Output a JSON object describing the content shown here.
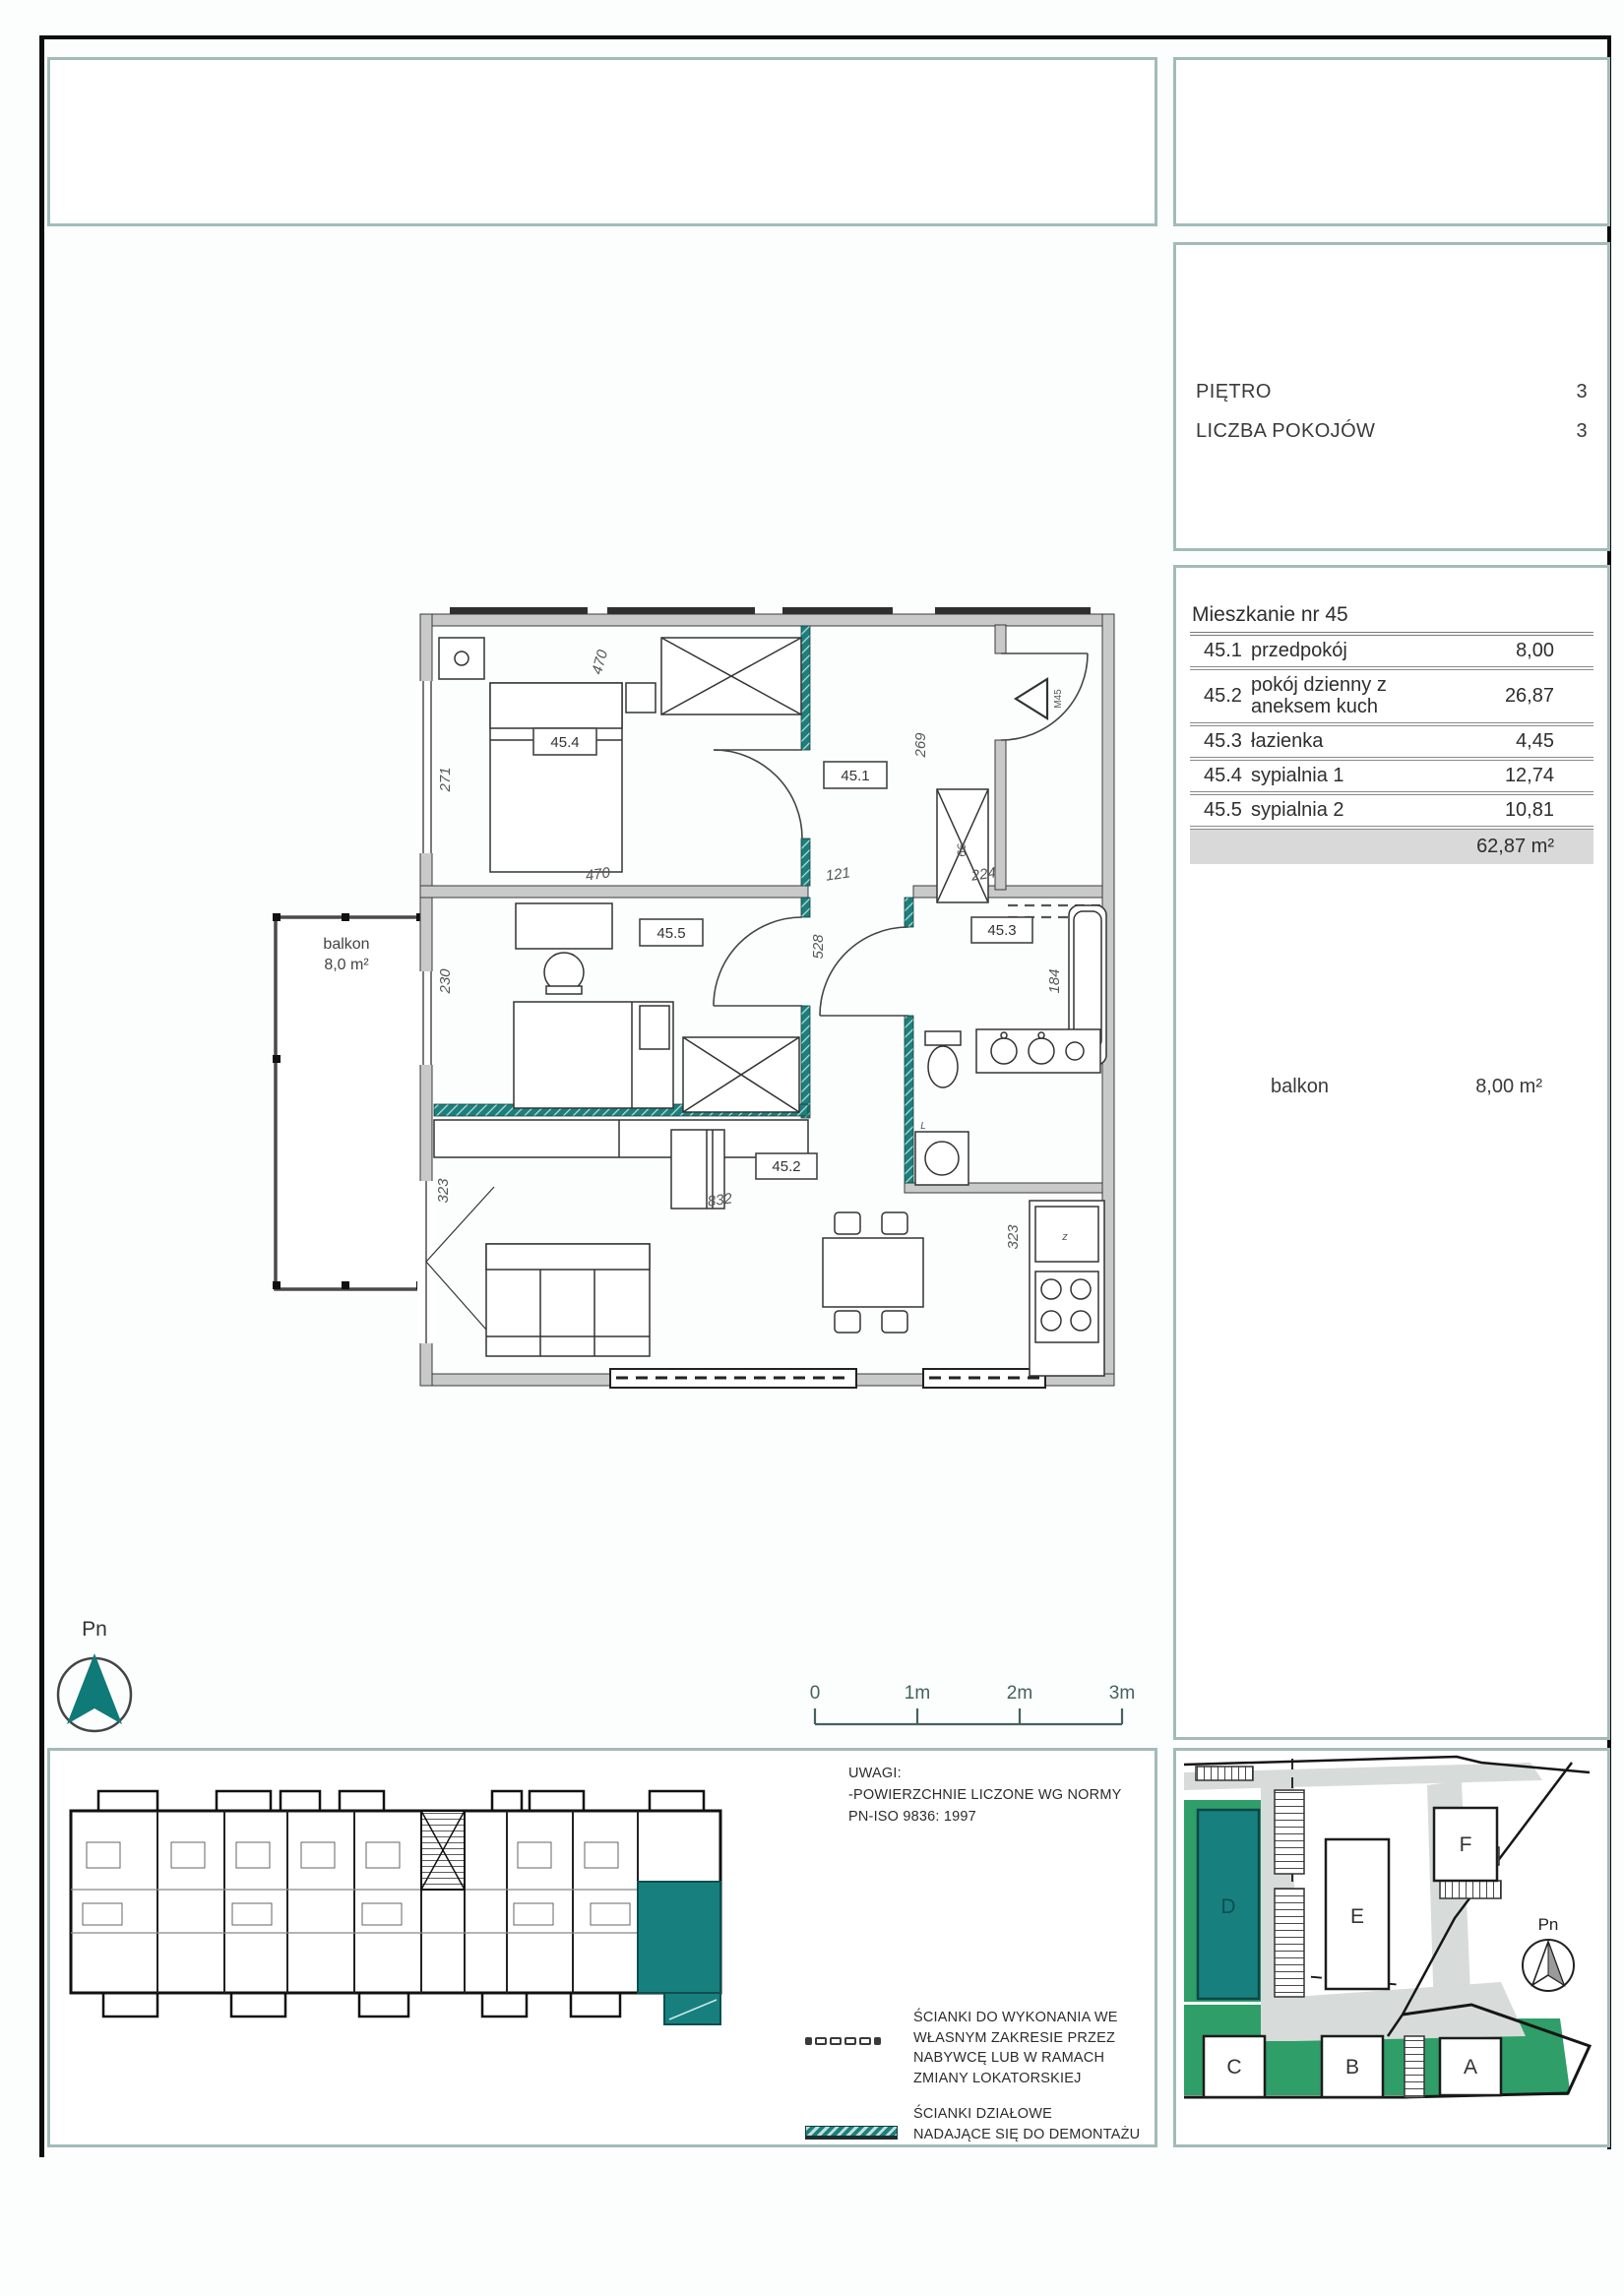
{
  "info_panel": {
    "floor_label": "PIĘTRO",
    "floor_value": "3",
    "rooms_label": "LICZBA POKOJÓW",
    "rooms_value": "3"
  },
  "apartment": {
    "title": "Mieszkanie nr 45",
    "rows": [
      {
        "no": "45.1",
        "name": "przedpokój",
        "area": "8,00"
      },
      {
        "no": "45.2",
        "name": "pokój dzienny z\naneksem kuch",
        "area": "26,87"
      },
      {
        "no": "45.3",
        "name": "łazienka",
        "area": "4,45"
      },
      {
        "no": "45.4",
        "name": "sypialnia 1",
        "area": "12,74"
      },
      {
        "no": "45.5",
        "name": "sypialnia 2",
        "area": "10,81"
      }
    ],
    "total_area": "62,87 m²",
    "balcony_label": "balkon",
    "balcony_area": "8,00 m²"
  },
  "floor_plan": {
    "rooms": {
      "r1": "45.1",
      "r2": "45.2",
      "r3": "45.3",
      "r4": "45.4",
      "r5": "45.5"
    },
    "balcony_name": "balkon",
    "balcony_size": "8,0 m²",
    "entrance": "M45",
    "dims": {
      "d271": "271",
      "d470a": "470",
      "d269": "269",
      "d66": "66",
      "d528": "528",
      "d121": "121",
      "d224": "224",
      "d230": "230",
      "d470b": "470",
      "d184": "184",
      "d832": "832",
      "d323a": "323",
      "d323b": "323",
      "fridge": "z",
      "washer": "L"
    }
  },
  "scale_bar": {
    "t0": "0",
    "t1": "1m",
    "t2": "2m",
    "t3": "3m"
  },
  "compass": {
    "label": "Pn"
  },
  "notes": {
    "title": "UWAGI:",
    "body": "-POWIERZCHNIE LICZONE WG NORMY\nPN-ISO 9836: 1997"
  },
  "legend": {
    "item1": "ŚCIANKI DO WYKONANIA WE\nWŁASNYM ZAKRESIE PRZEZ\nNABYWCĘ LUB W RAMACH\nZMIANY LOKATORSKIEJ",
    "item2": "ŚCIANKI DZIAŁOWE\nNADAJĄCE SIĘ DO DEMONTAŻU"
  },
  "site_plan": {
    "b_a": "A",
    "b_b": "B",
    "b_c": "C",
    "b_d": "D",
    "b_e": "E",
    "b_f": "F",
    "compass": "Pn"
  },
  "colors": {
    "teal_accent": "#17807e",
    "site_green": "#2f9e68",
    "wall_gray": "#c9c9c9",
    "box_border": "#a2bbb9"
  }
}
